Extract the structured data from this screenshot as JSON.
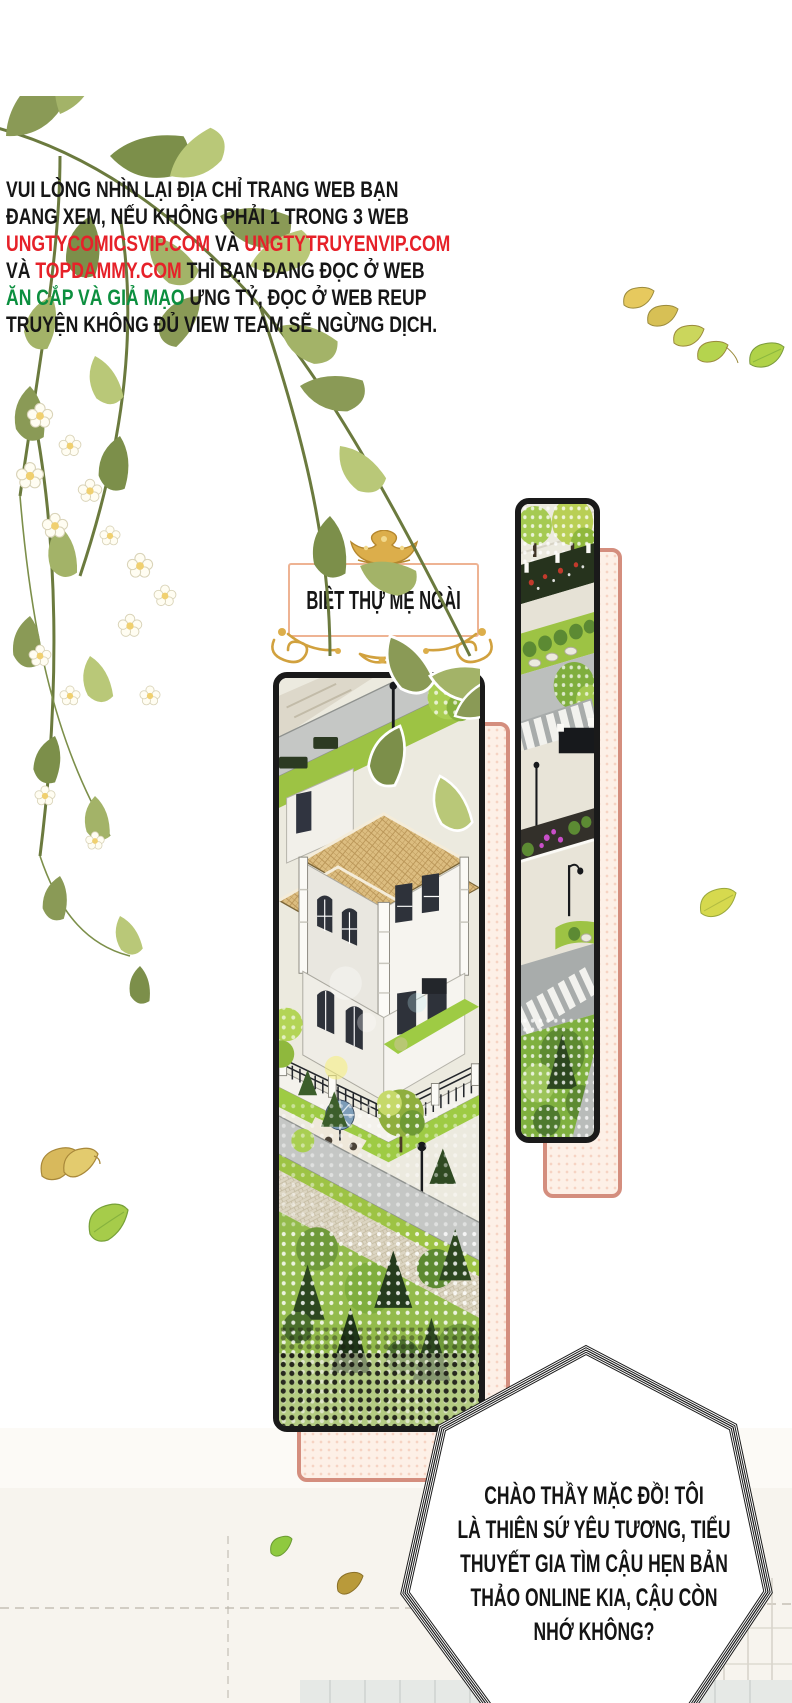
{
  "notice": {
    "lines": [
      {
        "segs": [
          {
            "t": "VUI LÒNG NHÌN LẠI ĐỊA CHỈ TRANG WEB BẠN",
            "c": "k"
          }
        ]
      },
      {
        "segs": [
          {
            "t": "ĐANG XEM, NẾU KHÔNG PHẢI 1 TRONG 3 WEB",
            "c": "k"
          }
        ]
      },
      {
        "segs": [
          {
            "t": "UNGTYCOMICSVIP.COM",
            "c": "r"
          },
          {
            "t": " VÀ ",
            "c": "k"
          },
          {
            "t": "UNGTYTRUYENVIP.COM",
            "c": "r"
          }
        ]
      },
      {
        "segs": [
          {
            "t": "VÀ ",
            "c": "k"
          },
          {
            "t": "TOPDAMMY.COM",
            "c": "r"
          },
          {
            "t": " THÌ BẠN ĐANG ĐỌC Ở WEB",
            "c": "k"
          }
        ]
      },
      {
        "segs": [
          {
            "t": "ĂN CẮP VÀ GIẢ MẠO",
            "c": "g"
          },
          {
            "t": " ƯNG TỶ, ĐỌC Ở WEB REUP",
            "c": "k"
          }
        ]
      },
      {
        "segs": [
          {
            "t": "TRUYỆN KHÔNG ĐỦ VIEW TEAM SẼ NGỪNG DỊCH.",
            "c": "k"
          }
        ]
      }
    ]
  },
  "panel_label": {
    "text": "BIỆT THỰ MẸ NGÀI"
  },
  "speech": {
    "lines": [
      "CHÀO THẦY MẶC ĐỒ! TÔI",
      "LÀ THIÊN SỨ YÊU TƯƠNG, TIỂU",
      "THUYẾT GIA TÌM CẬU HẸN BẢN",
      "THẢO ONLINE KIA, CẬU CÒN",
      "NHỚ KHÔNG?"
    ]
  },
  "colors": {
    "link_red": "#e62129",
    "warn_green": "#0c8f3f",
    "text_black": "#161616",
    "gold_ornament": "#d8a843",
    "panel_border": "#1a1a1a",
    "backer_border": "#d48e7e",
    "backer_fill": "#fdf0e7"
  },
  "decorations": [
    "flower-branch-illustration",
    "crown-ornament-icon",
    "flourish-ornament-icon",
    "falling-leaf-icon",
    "villa-illustration",
    "street-illustration"
  ]
}
